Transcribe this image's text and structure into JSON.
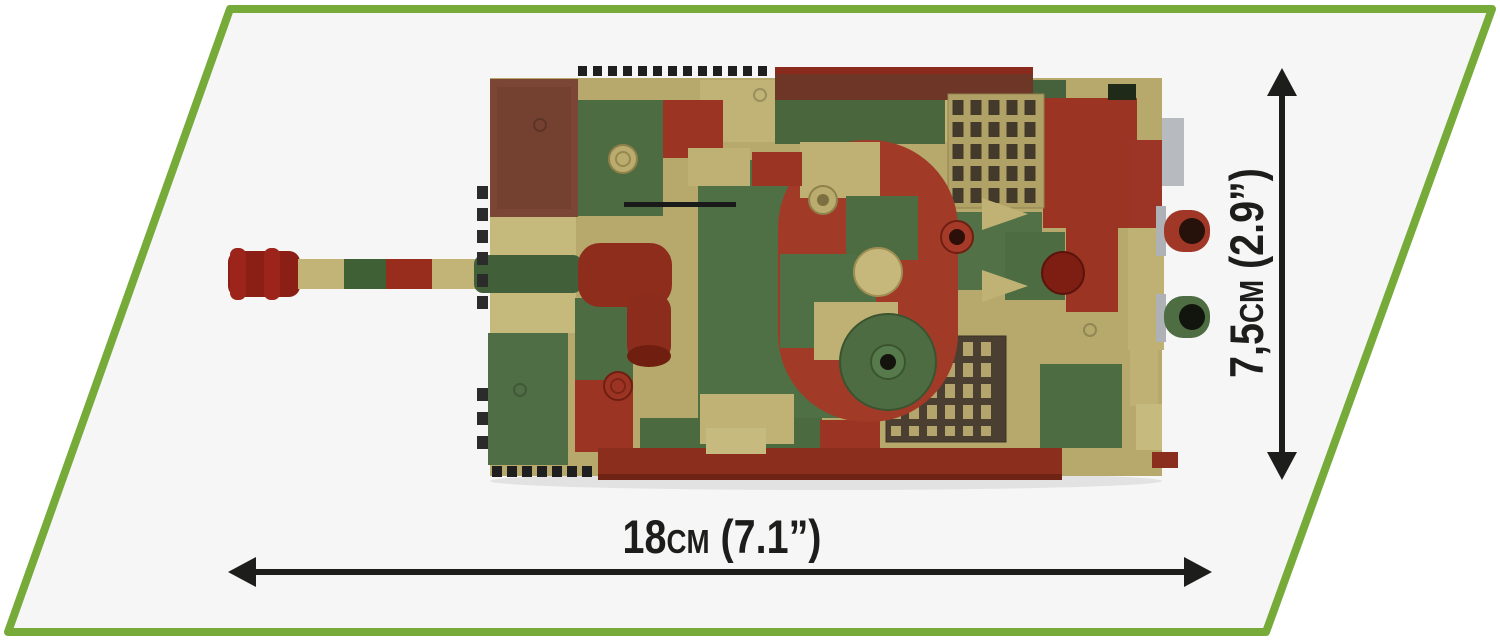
{
  "page": {
    "background": "#ffffff"
  },
  "panel": {
    "shape": "parallelogram",
    "fill": "#f6f6f7",
    "border_color": "#76ab3a",
    "border_width_px": 8
  },
  "dimensions": {
    "length_label": "18cm (7.1”)",
    "width_label": "7,5cm (2.9”)",
    "arrow_color": "#1d1d1b",
    "label_color": "#1d1d1b"
  },
  "model": {
    "subject": "camouflaged brick-built tank, top view, barrel pointing left",
    "palette": {
      "tan": "#bfb173",
      "light_tan": "#c7ba7e",
      "olive_green": "#4e6c42",
      "brick_red": "#9c3423",
      "track_brown": "#6e3626",
      "muzzle_red": "#8c1f15",
      "stud_black": "#1f1f1f",
      "gray_part": "#b7babe"
    }
  },
  "icons": {
    "length_arrow": "double-arrow-horizontal-icon",
    "width_arrow": "double-arrow-vertical-icon"
  }
}
